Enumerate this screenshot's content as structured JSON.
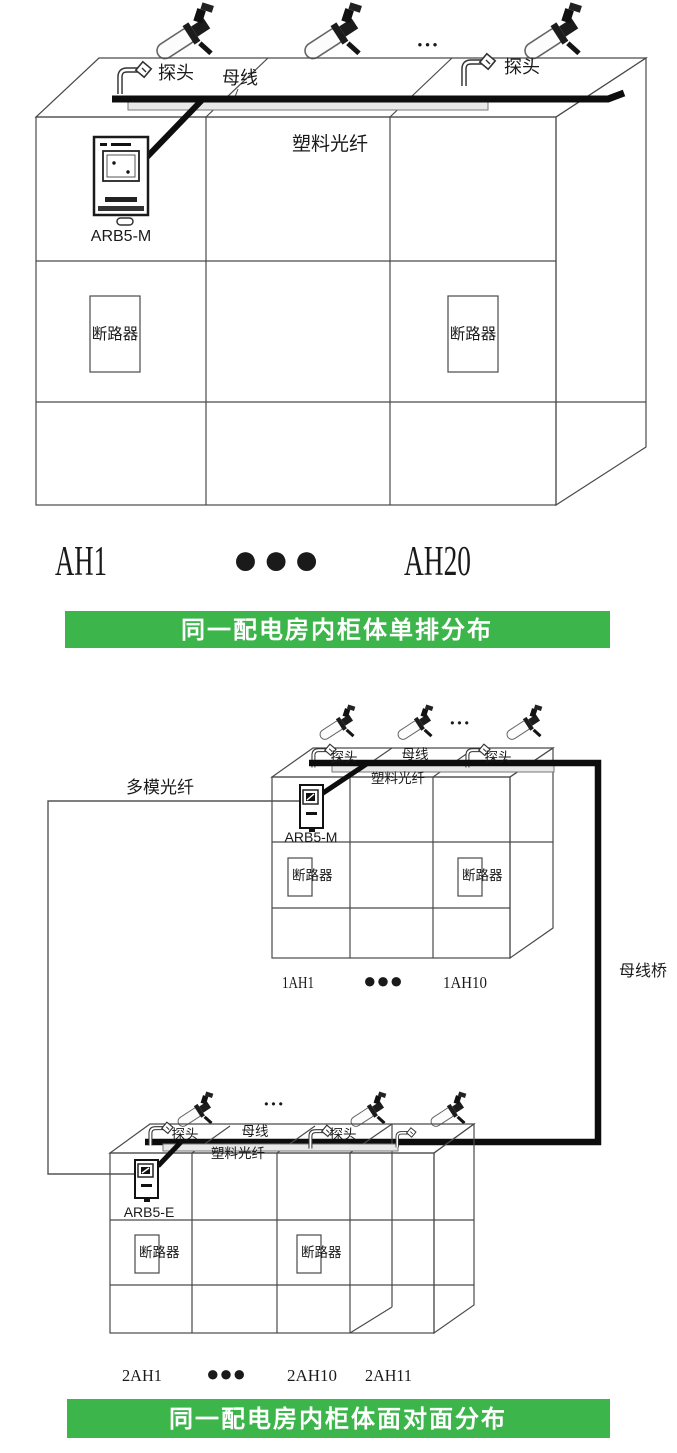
{
  "colors": {
    "banner_green": "#3cb54a",
    "device_label_blue": "#2e5bd0",
    "device_label_navy": "#36456a",
    "ellipsis_blue": "#2b3fae"
  },
  "diagram1": {
    "ellipsis": "•••",
    "probe_label_left": "探头",
    "busbar_label": "母线",
    "probe_label_right": "探头",
    "fiber_label": "塑料光纤",
    "device_label": "ARB5-M",
    "breaker_label_left": "断路器",
    "breaker_label_right": "断路器",
    "cabinet_first_label": "AH1",
    "cabinet_dots": "●●●",
    "cabinet_last_label": "AH20",
    "caption": "同一配电房内柜体单排分布"
  },
  "diagram2": {
    "multimode_fiber_label": "多模光纤",
    "busbar_bridge_label": "母线桥",
    "caption": "同一配电房内柜体面对面分布",
    "upper": {
      "ellipsis": "•••",
      "probe_label_left": "探头",
      "busbar_label": "母线",
      "probe_label_right": "探头",
      "fiber_label": "塑料光纤",
      "device_label": "ARB5-M",
      "breaker_label_left": "断路器",
      "breaker_label_right": "断路器",
      "cabinet_first_label": "1AH1",
      "cabinet_dots": "●●●",
      "cabinet_last_label": "1AH10"
    },
    "lower": {
      "ellipsis": "•••",
      "probe_label_left": "探头",
      "busbar_label": "母线",
      "probe_label_right": "探头",
      "fiber_label": "塑料光纤",
      "device_label": "ARB5-E",
      "breaker_label_left": "断路器",
      "breaker_label_right": "断路器",
      "cabinet_first_label": "2AH1",
      "cabinet_dots": "●●●",
      "cabinet_mid_label": "2AH10",
      "cabinet_last_label": "2AH11"
    }
  }
}
